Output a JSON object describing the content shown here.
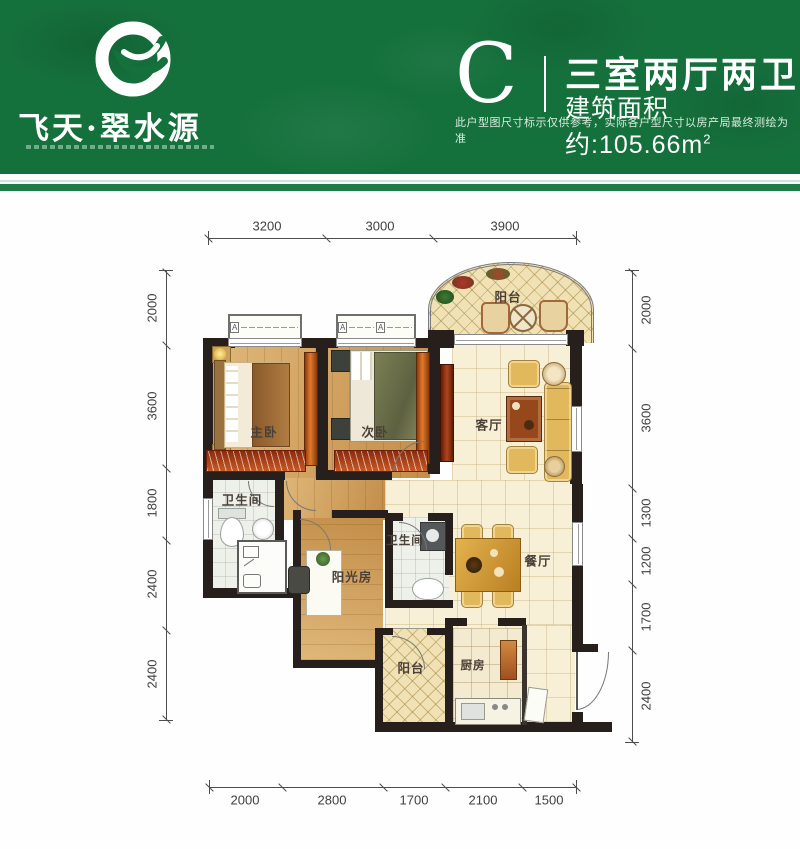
{
  "header": {
    "brand": "飞天·翠水源",
    "unit_letter": "C",
    "unit_type": "三室两厅两卫",
    "area_label": "建筑面积约:105.66m",
    "area_sup": "2",
    "disclaimer": "此户型图尺寸标示仅供参考，实际各户型尺寸以房产局最终测绘为准",
    "colors": {
      "header_green": "#15713c",
      "stripe_green": "#1e7d46"
    }
  },
  "plan": {
    "window_mark": "A",
    "rooms": [
      {
        "id": "balcony-top",
        "label": "阳台"
      },
      {
        "id": "master-bedroom",
        "label": "主卧"
      },
      {
        "id": "second-bedroom",
        "label": "次卧"
      },
      {
        "id": "living-room",
        "label": "客厅"
      },
      {
        "id": "bathroom-1",
        "label": "卫生间"
      },
      {
        "id": "sunroom",
        "label": "阳光房"
      },
      {
        "id": "bathroom-2",
        "label": "卫生间"
      },
      {
        "id": "dining-room",
        "label": "餐厅"
      },
      {
        "id": "balcony-bottom",
        "label": "阳台"
      },
      {
        "id": "kitchen",
        "label": "厨房"
      }
    ],
    "dimensions": {
      "top": [
        "3200",
        "3000",
        "3900"
      ],
      "bottom": [
        "2000",
        "2800",
        "1700",
        "2100",
        "1500"
      ],
      "left": [
        "2000",
        "3600",
        "1800",
        "2400",
        "2400"
      ],
      "right": [
        "2000",
        "3600",
        "1300",
        "1200",
        "1700",
        "2400"
      ]
    }
  }
}
